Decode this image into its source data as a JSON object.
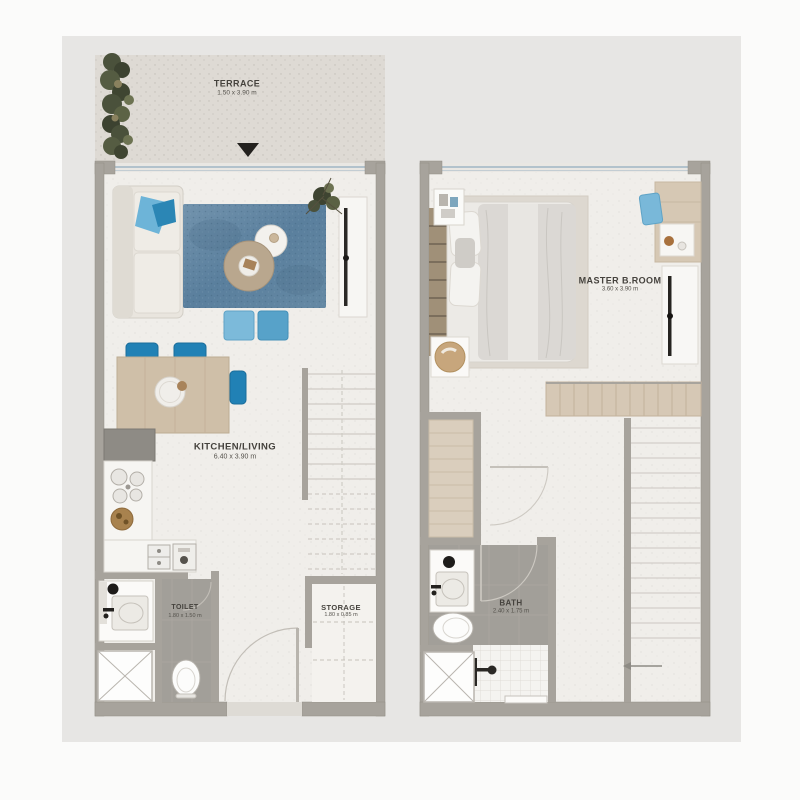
{
  "page": {
    "background": "#fbfbfa",
    "panel_background": "#e7e6e4"
  },
  "colors": {
    "wall": "#a7a39c",
    "floor": "#f0eeea",
    "terrace_floor": "#dedad4",
    "wet_room_floor": "#a29f99",
    "wood": "#d6c8b5",
    "rug_blue": "#5f85a3",
    "chair_blue": "#2181b5",
    "pouf_blue_light": "#7cbada",
    "pouf_blue_dark": "#57a2c9",
    "window_glass": "#9fb6c4",
    "label_text": "#45423d",
    "greenery": "#4a513b"
  },
  "floors": {
    "ground": {
      "terrace": {
        "name": "TERRACE",
        "dims": "1.50 x 3.90 m"
      },
      "kitchen_living": {
        "name": "KITCHEN/LIVING",
        "dims": "6.40 x 3.90 m"
      },
      "toilet": {
        "name": "TOILET",
        "dims": "1.80 x 1.50 m"
      },
      "storage": {
        "name": "STORAGE",
        "dims": "1.80 x 0.85 m"
      }
    },
    "upper": {
      "master_bedroom": {
        "name": "MASTER B.ROOM",
        "dims": "3.60 x 3.90 m"
      },
      "bath": {
        "name": "BATH",
        "dims": "2.40 x 1.75 m"
      }
    }
  }
}
